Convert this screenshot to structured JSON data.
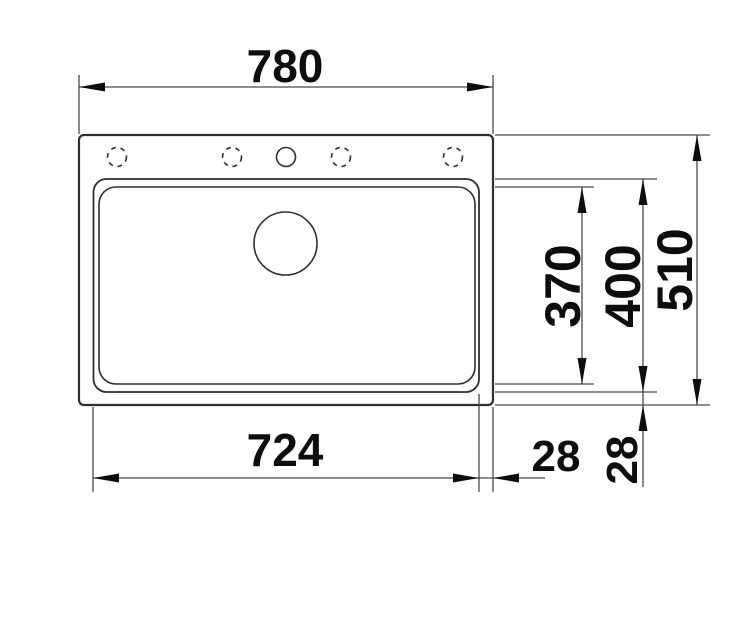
{
  "drawing": {
    "title": "sink-top-view-technical-drawing",
    "dimensions": {
      "overall_width": "780",
      "bowl_width": "724",
      "ledge_horizontal": "28",
      "ledge_vertical": "28",
      "bowl_inner_depth": "370",
      "bowl_outer_depth": "400",
      "overall_depth": "510"
    },
    "features": {
      "tap_holes_total": "5",
      "tap_holes_drilled": "1"
    },
    "colors": {
      "background": "#ffffff",
      "outline": "#2f2f2f",
      "dimension_line": "#4a4a4a",
      "text_and_arrows": "#0d0d0d"
    }
  }
}
